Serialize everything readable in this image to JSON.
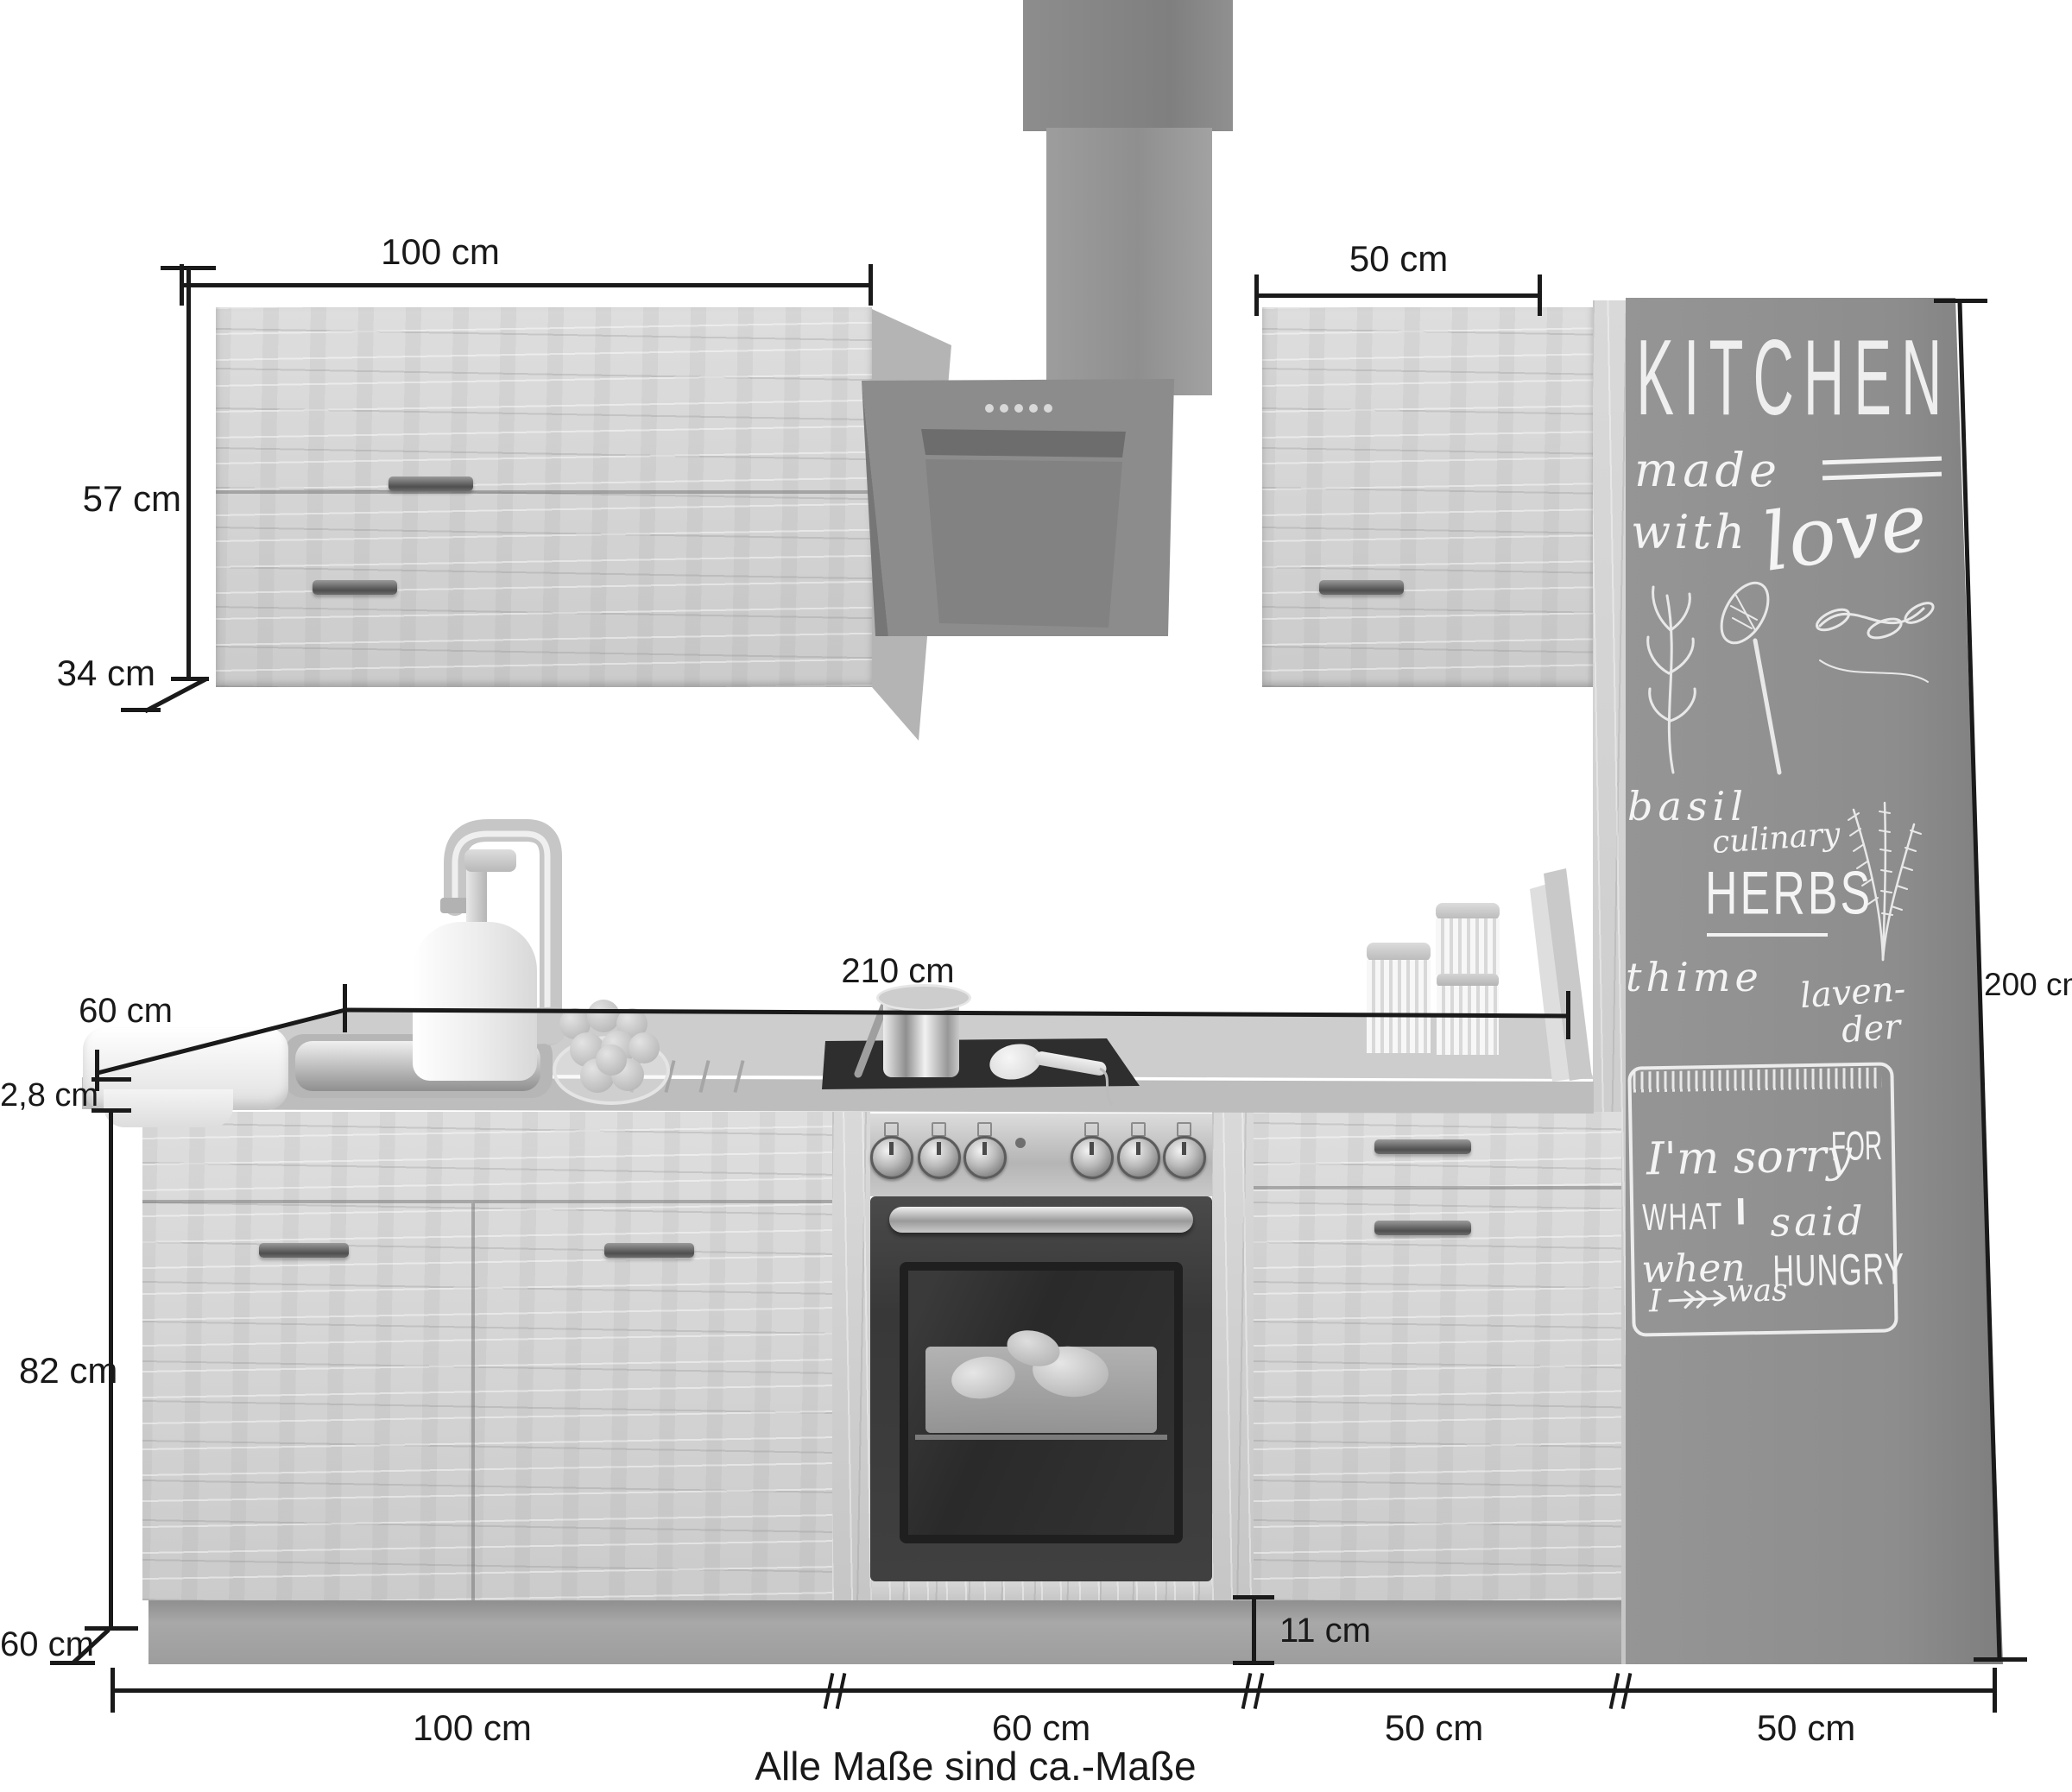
{
  "note": "Alle Maße sind ca.-Maße",
  "dims": {
    "wall_left_w": "100 cm",
    "wall_right_w": "50 cm",
    "wall_h": "57 cm",
    "wall_d": "34 cm",
    "counter_d": "60 cm",
    "counter_t": "2,8 cm",
    "counter_run": "210 cm",
    "tall_h": "200 cm",
    "base_h": "82 cm",
    "base_d": "60 cm",
    "plinth_h": "11 cm",
    "seg1": "100 cm",
    "seg2": "60 cm",
    "seg3": "50 cm",
    "seg4": "50 cm"
  },
  "board": {
    "title": "KITCHEN",
    "made": "made",
    "with": "with",
    "love": "love",
    "basil": "basil",
    "culinary": "culinary",
    "herbs": "HERBS",
    "thime": "thime",
    "laven": "laven-",
    "der": "der",
    "q_im_sorry": "I'm sorry",
    "q_for": "FOR",
    "q_what": "WHAT",
    "q_i": "I",
    "q_said": "said",
    "q_when": "when",
    "q_i2": "I",
    "q_was": "was",
    "q_hungry": "HUNGRY"
  }
}
